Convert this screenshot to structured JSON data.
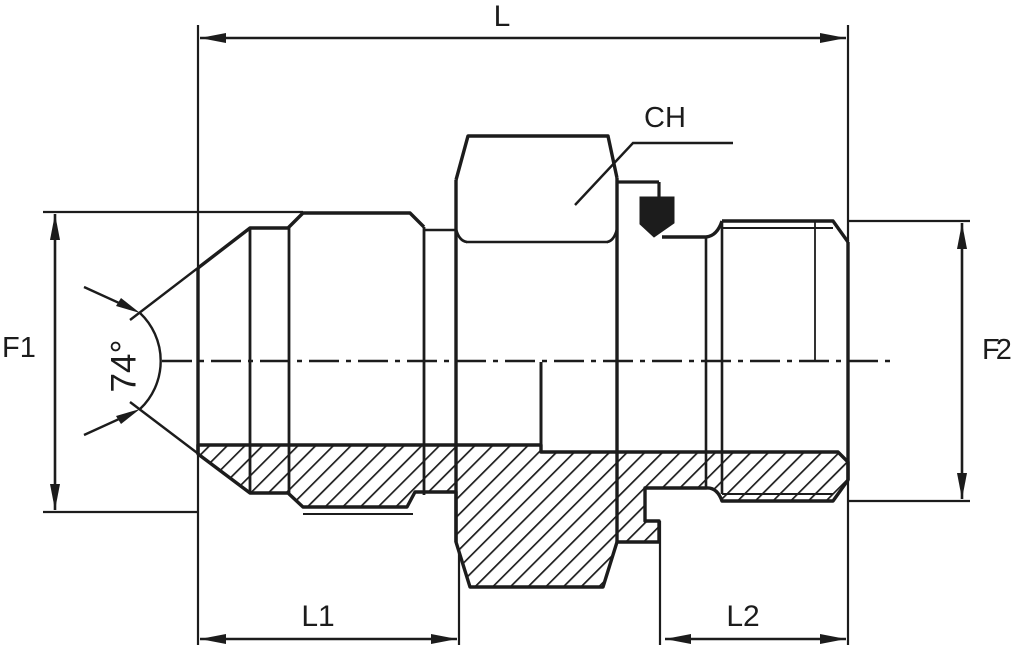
{
  "drawing": {
    "labels": {
      "overall_length": "L",
      "hex_wrench_size": "CH",
      "left_thread_diameter": "F1",
      "right_thread_diameter": "F2",
      "cone_angle": "74°",
      "left_length": "L1",
      "right_length": "L2"
    },
    "colors": {
      "line": "#1c1c1c",
      "background": "#ffffff"
    }
  }
}
